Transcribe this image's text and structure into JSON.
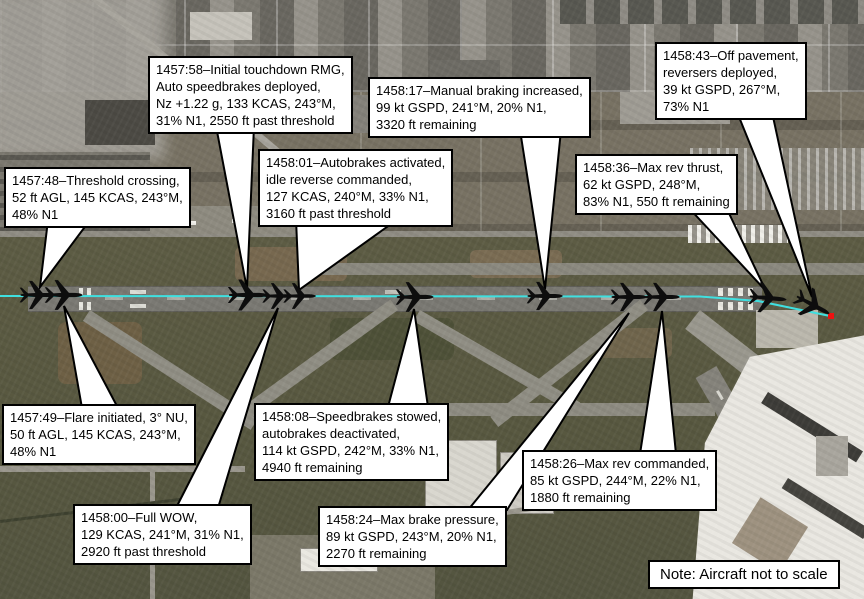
{
  "figure": {
    "note": "Note: Aircraft not to scale",
    "path_color": "#3fe0e0",
    "end_marker_color": "#ee1111",
    "aircraft_color": "#0d0d0d",
    "callout_bg": "#ffffff",
    "callout_border": "#000000"
  },
  "callouts": [
    {
      "id": "threshold-crossing",
      "time": "1457:48",
      "text": "1457:48–Threshold crossing,\n52 ft AGL, 145 KCAS, 243°M,\n48% N1"
    },
    {
      "id": "flare-initiated",
      "time": "1457:49",
      "text": "1457:49–Flare initiated, 3° NU,\n50 ft AGL, 145 KCAS, 243°M,\n48% N1"
    },
    {
      "id": "initial-touchdown",
      "time": "1457:58",
      "text": "1457:58–Initial touchdown RMG,\nAuto speedbrakes deployed,\nNz +1.22 g, 133 KCAS, 243°M,\n31% N1, 2550 ft past threshold"
    },
    {
      "id": "full-wow",
      "time": "1458:00",
      "text": "1458:00–Full WOW,\n129 KCAS, 241°M, 31% N1,\n2920 ft past threshold"
    },
    {
      "id": "autobrakes-activated",
      "time": "1458:01",
      "text": "1458:01–Autobrakes activated,\nidle reverse commanded,\n127 KCAS, 240°M, 33% N1,\n3160 ft past threshold"
    },
    {
      "id": "speedbrakes-stowed",
      "time": "1458:08",
      "text": "1458:08–Speedbrakes stowed,\nautobrakes deactivated,\n114 kt GSPD, 242°M, 33% N1,\n4940 ft remaining"
    },
    {
      "id": "manual-braking",
      "time": "1458:17",
      "text": "1458:17–Manual braking increased,\n99 kt GSPD, 241°M, 20% N1,\n3320 ft remaining"
    },
    {
      "id": "max-brake-pressure",
      "time": "1458:24",
      "text": "1458:24–Max brake pressure,\n89 kt GSPD, 243°M, 20% N1,\n2270 ft remaining"
    },
    {
      "id": "max-rev-commanded",
      "time": "1458:26",
      "text": "1458:26–Max rev commanded,\n85 kt GSPD, 244°M, 22% N1,\n1880 ft remaining"
    },
    {
      "id": "max-rev-thrust",
      "time": "1458:36",
      "text": "1458:36–Max rev thrust,\n62 kt GSPD, 248°M,\n83% N1, 550 ft remaining"
    },
    {
      "id": "off-pavement",
      "time": "1458:43",
      "text": "1458:43–Off pavement,\nreversers deployed,\n39 kt GSPD, 267°M,\n73% N1"
    }
  ]
}
